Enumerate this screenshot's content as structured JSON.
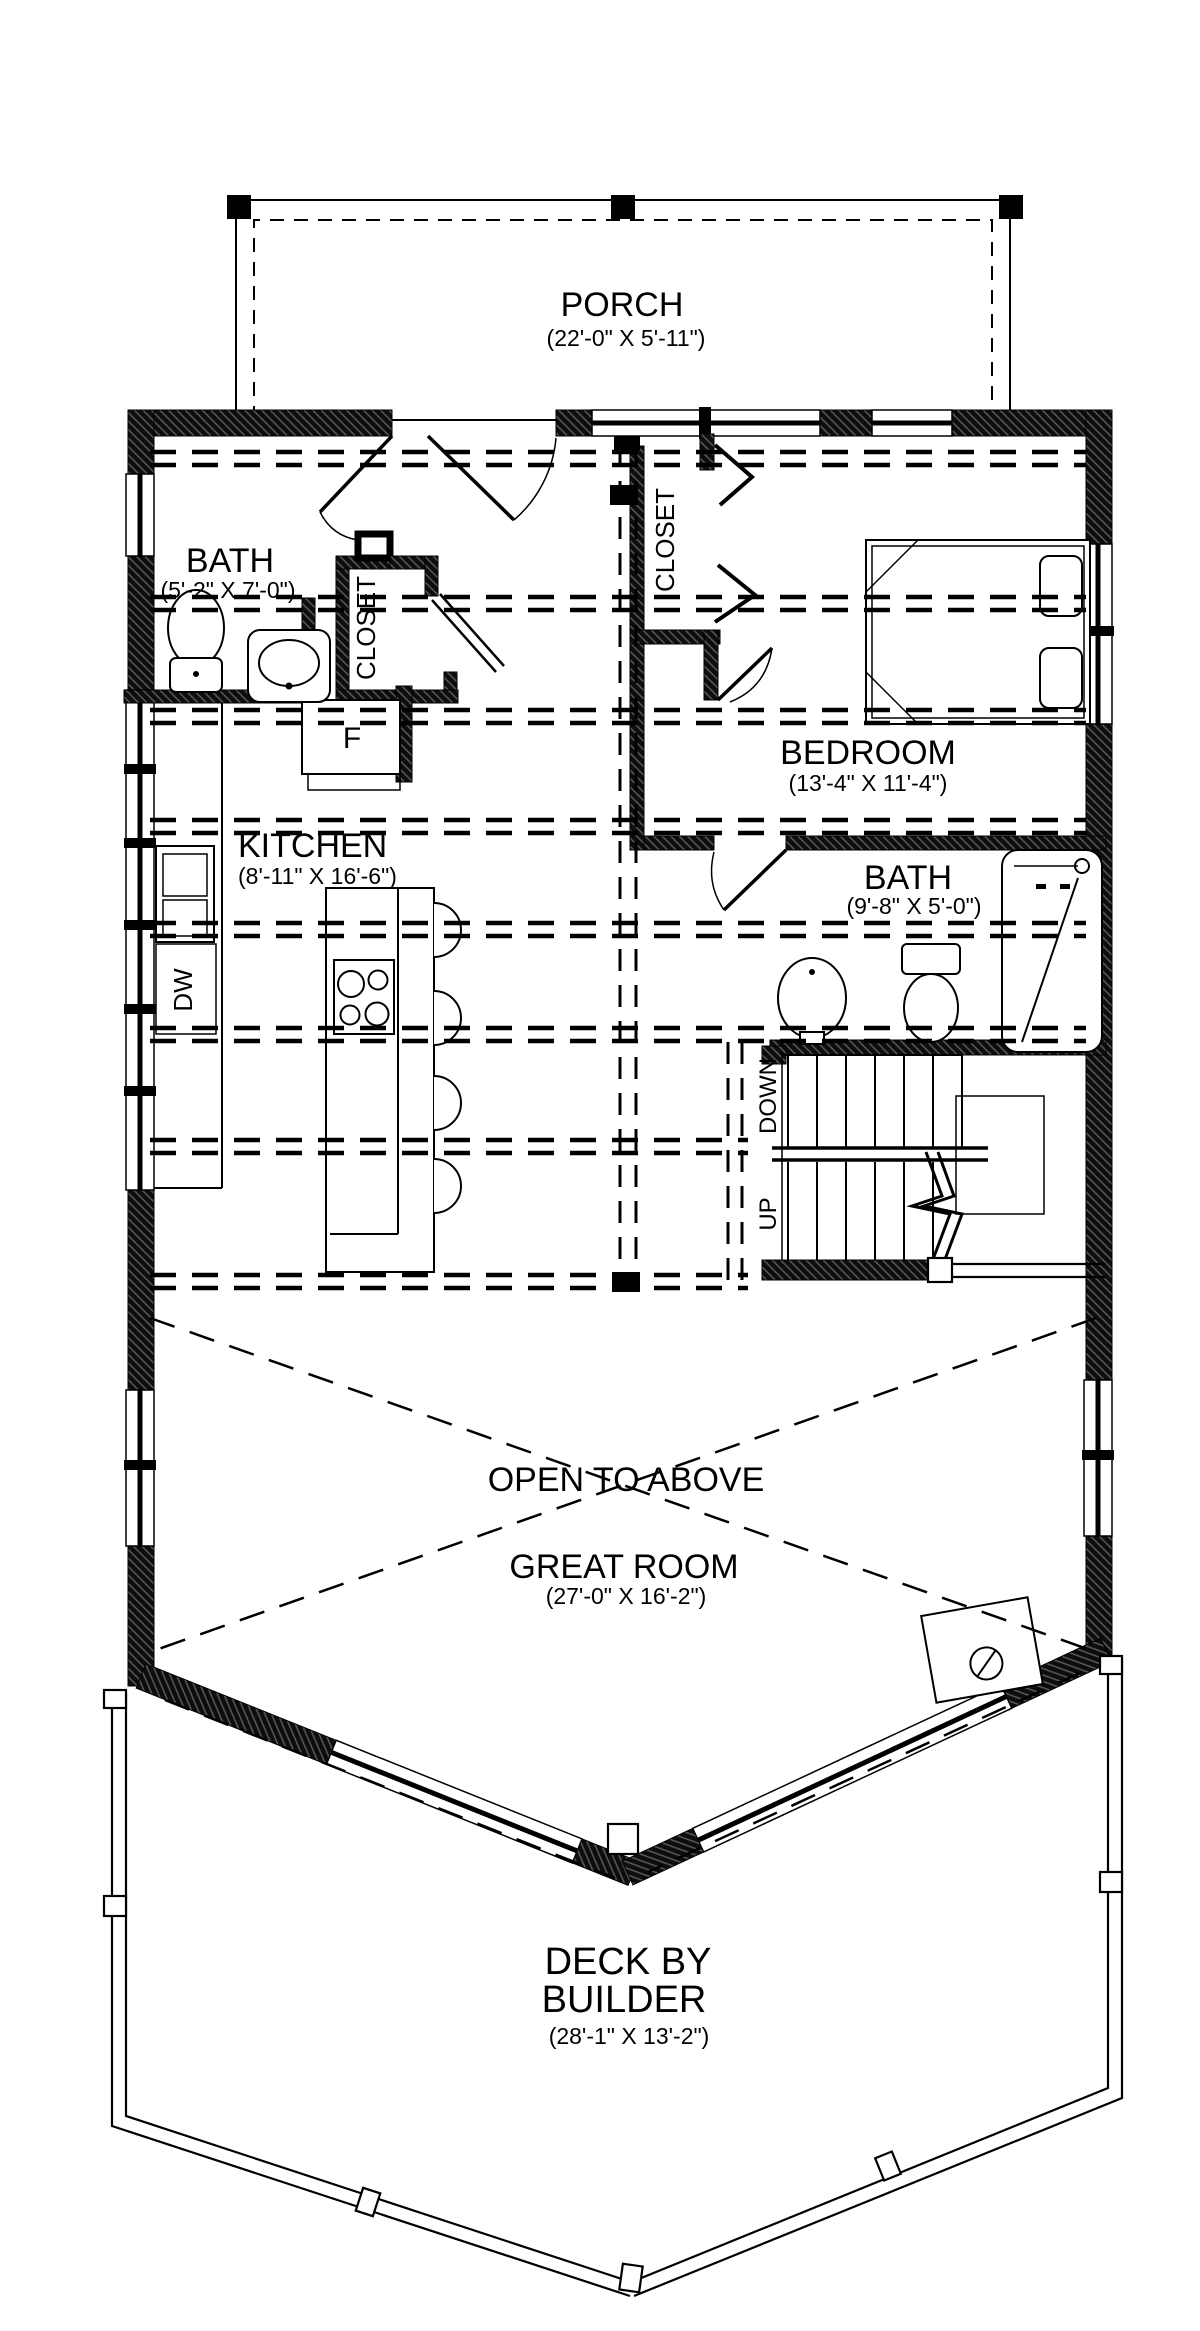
{
  "rooms": {
    "porch": {
      "label": "PORCH",
      "dims": "(22'-0\" X 5'-11\")"
    },
    "bath_upper_left": {
      "label": "BATH",
      "dims": "(5'-2\" X 7'-0\")"
    },
    "entry_closet": {
      "label": "CLOSET"
    },
    "bedroom_closet": {
      "label": "CLOSET"
    },
    "bedroom": {
      "label": "BEDROOM",
      "dims": "(13'-4\" X 11'-4\")"
    },
    "kitchen": {
      "label": "KITCHEN",
      "dims": "(8'-11\" X 16'-6\")"
    },
    "bath_main": {
      "label": "BATH",
      "dims": "(9'-8\" X 5'-0\")"
    },
    "great_room": {
      "label": "GREAT ROOM",
      "dims": "(27'-0\" X 16'-2\")",
      "annotation": "OPEN TO ABOVE"
    },
    "deck": {
      "label_line1": "DECK BY",
      "label_line2": "BUILDER",
      "dims": "(28'-1\" X 13'-2\")"
    }
  },
  "stairs": {
    "down_label": "DOWN",
    "up_label": "UP"
  },
  "appliances": {
    "fridge_label": "F",
    "dishwasher_label": "DW"
  },
  "colors": {
    "line": "#000000",
    "background": "#ffffff"
  }
}
